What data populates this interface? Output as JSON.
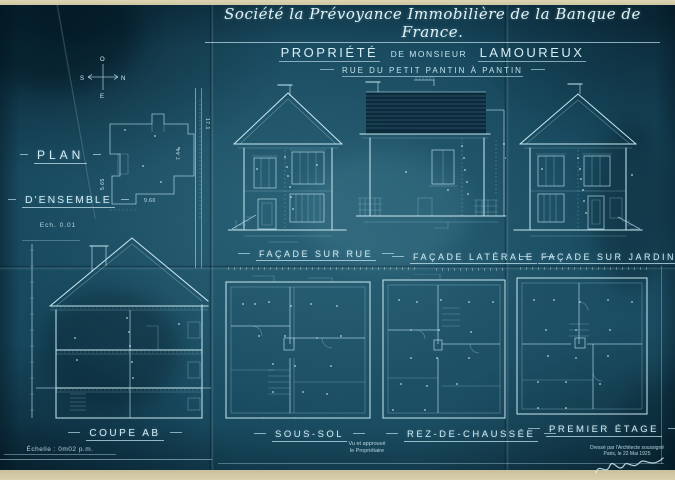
{
  "title": {
    "line1": "Société la Prévoyance Immobilière de la Banque de France.",
    "line2_part1": "PROPRIÉTÉ",
    "line2_part2": "DE MONSIEUR",
    "line2_part3": "LAMOUREUX",
    "line3": "RUE DU PETIT PANTIN À PANTIN"
  },
  "compass": {
    "o": "O",
    "s": "S",
    "n": "N",
    "e": "E"
  },
  "plan_ensemble": {
    "label_line1": "PLAN",
    "label_line2": "D'ENSEMBLE",
    "scale": "Ech. 0.01",
    "dim_height": "7.44",
    "dim_width": "9.60",
    "dim_left": "5.65",
    "dim_street": "17.1"
  },
  "drawings": {
    "facade_rue": "FAÇADE SUR RUE",
    "facade_laterale": "FAÇADE LATÉRALE",
    "facade_jardin": "FAÇADE SUR JARDIN",
    "coupe": "COUPE AB",
    "sous_sol": "SOUS-SOL",
    "rez_de_chaussee": "REZ-DE-CHAUSSÉE",
    "premier_etage": "PREMIER ÉTAGE"
  },
  "footer": {
    "echelle": "Échelle : 0m02 p.m.",
    "approval_line1": "Vu et approuvé",
    "approval_line2": "le Propriétaire",
    "credit_line1": "Dressé par l'Architecte soussigné",
    "credit_line2": "Paris, le 22 Mai 1925"
  },
  "colors": {
    "blueprint": "#17485d",
    "line_light": "#c9e9f1",
    "paper_edge": "#d6cead",
    "dark_patch": "#0a2838"
  }
}
